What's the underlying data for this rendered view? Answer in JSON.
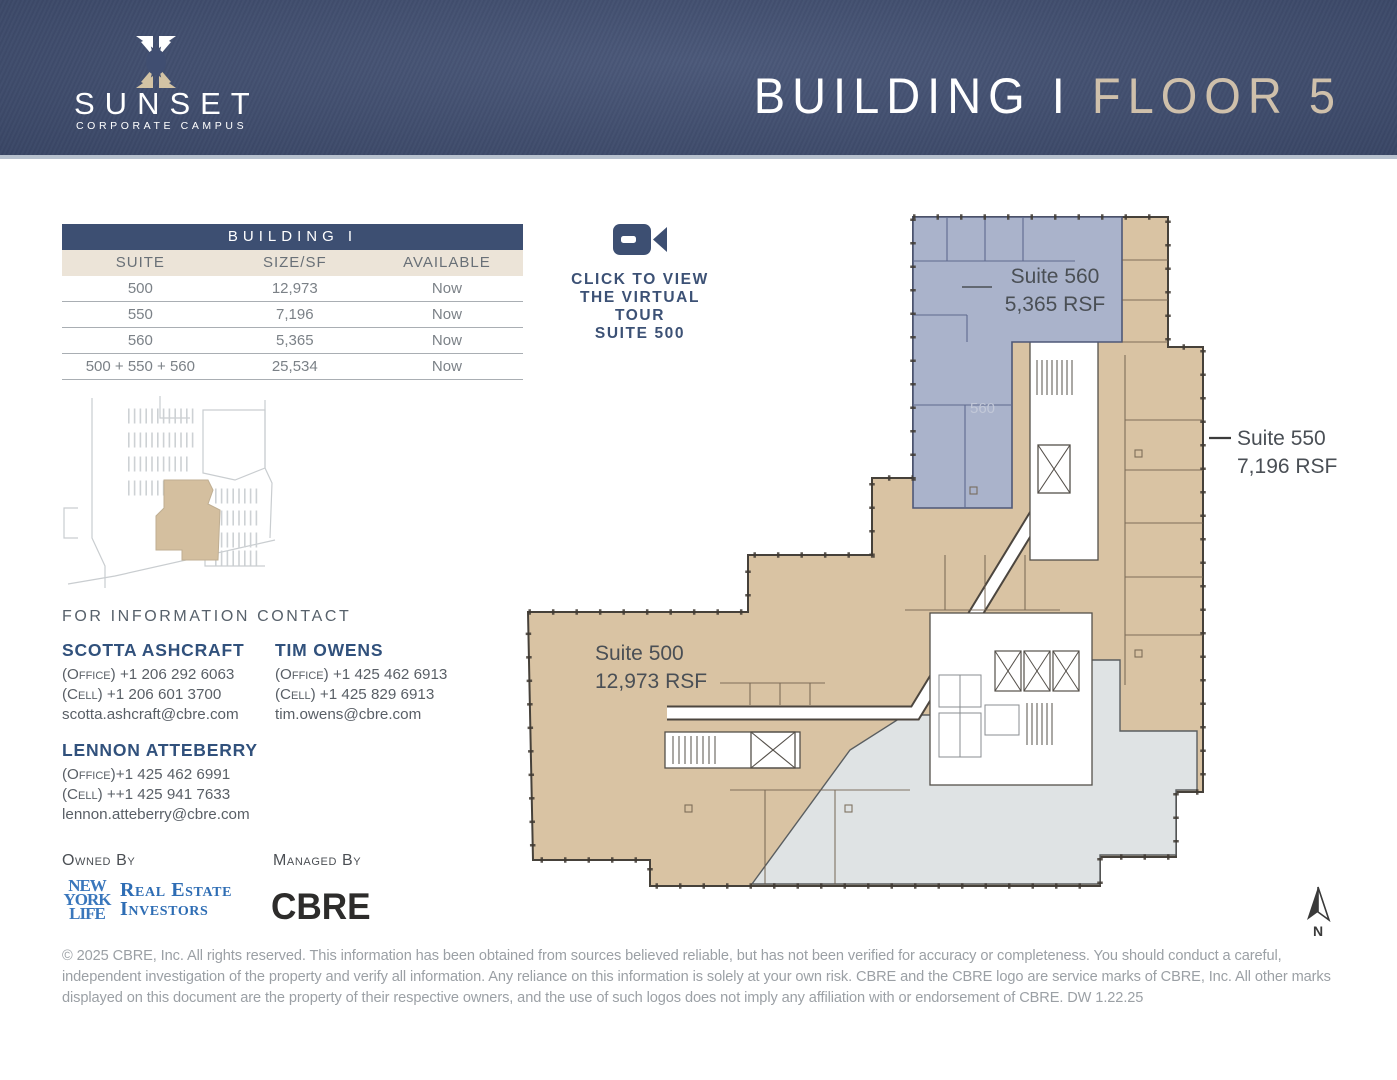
{
  "colors": {
    "header_navy": "#404e71",
    "table_navy": "#3d4f72",
    "cream": "#ece4d8",
    "suite_tan": "#d9c3a3",
    "suite_blue": "#aab3cb",
    "common_gray": "#dfe3e4",
    "nyl_blue": "#3a77bc",
    "cbre_dark": "#2d2c2b"
  },
  "header": {
    "logo_word": "SUNSET",
    "logo_tagline": "CORPORATE CAMPUS",
    "title_building": "BUILDING I ",
    "title_floor": "FLOOR 5"
  },
  "availability_table": {
    "title": "BUILDING I",
    "columns": [
      "SUITE",
      "SIZE/SF",
      "AVAILABLE"
    ],
    "rows": [
      [
        "500",
        "12,973",
        "Now"
      ],
      [
        "550",
        "7,196",
        "Now"
      ],
      [
        "560",
        "5,365",
        "Now"
      ],
      [
        "500 + 550 + 560",
        "25,534",
        "Now"
      ]
    ]
  },
  "virtual_tour": {
    "line1": "CLICK TO VIEW",
    "line2": "THE VIRTUAL TOUR",
    "line3": "SUITE 500"
  },
  "contacts": {
    "heading": "FOR INFORMATION CONTACT",
    "people": [
      {
        "name": "SCOTTA ASHCRAFT",
        "office_label": "(Office)",
        "office": " +1 206 292 6063",
        "cell_label": "(Cell)",
        "cell": " +1 206 601 3700",
        "email": "scotta.ashcraft@cbre.com"
      },
      {
        "name": "TIM OWENS",
        "office_label": "(Office)",
        "office": " +1 425 462 6913",
        "cell_label": "(Cell)",
        "cell": " +1 425 829 6913",
        "email": "tim.owens@cbre.com"
      },
      {
        "name": "LENNON ATTEBERRY",
        "office_label": "(Office)",
        "office": "+1 425 462 6991",
        "cell_label": "(Cell)",
        "cell": " ++1 425 941 7633",
        "email": "lennon.atteberry@cbre.com"
      }
    ]
  },
  "ownership": {
    "owned_label": "Owned By",
    "managed_label": "Managed By",
    "nyl_line1": "NEW",
    "nyl_line2": "YORK",
    "nyl_line3": "LIFE",
    "nyl_partner_line1": "Real Estate",
    "nyl_partner_line2": "Investors",
    "cbre": "CBRE"
  },
  "floor_plan": {
    "suite_560": {
      "name": "Suite 560",
      "rsf": "5,365 RSF",
      "watermark": "560"
    },
    "suite_550": {
      "name": "Suite 550",
      "rsf": "7,196 RSF"
    },
    "suite_500": {
      "name": "Suite 500",
      "rsf": "12,973 RSF"
    },
    "compass": "N"
  },
  "footer": {
    "disclaimer": "© 2025 CBRE, Inc. All rights reserved. This information has been obtained from sources believed reliable, but has not been verified for accuracy or completeness. You should conduct a careful, independent investigation of the property and verify all information. Any reliance on this information is solely at your own risk. CBRE and the CBRE logo are service marks of CBRE, Inc. All other marks displayed on this document are the property of their respective owners, and the use of such logos does not imply any affiliation with or endorsement of CBRE. DW 1.22.25"
  }
}
